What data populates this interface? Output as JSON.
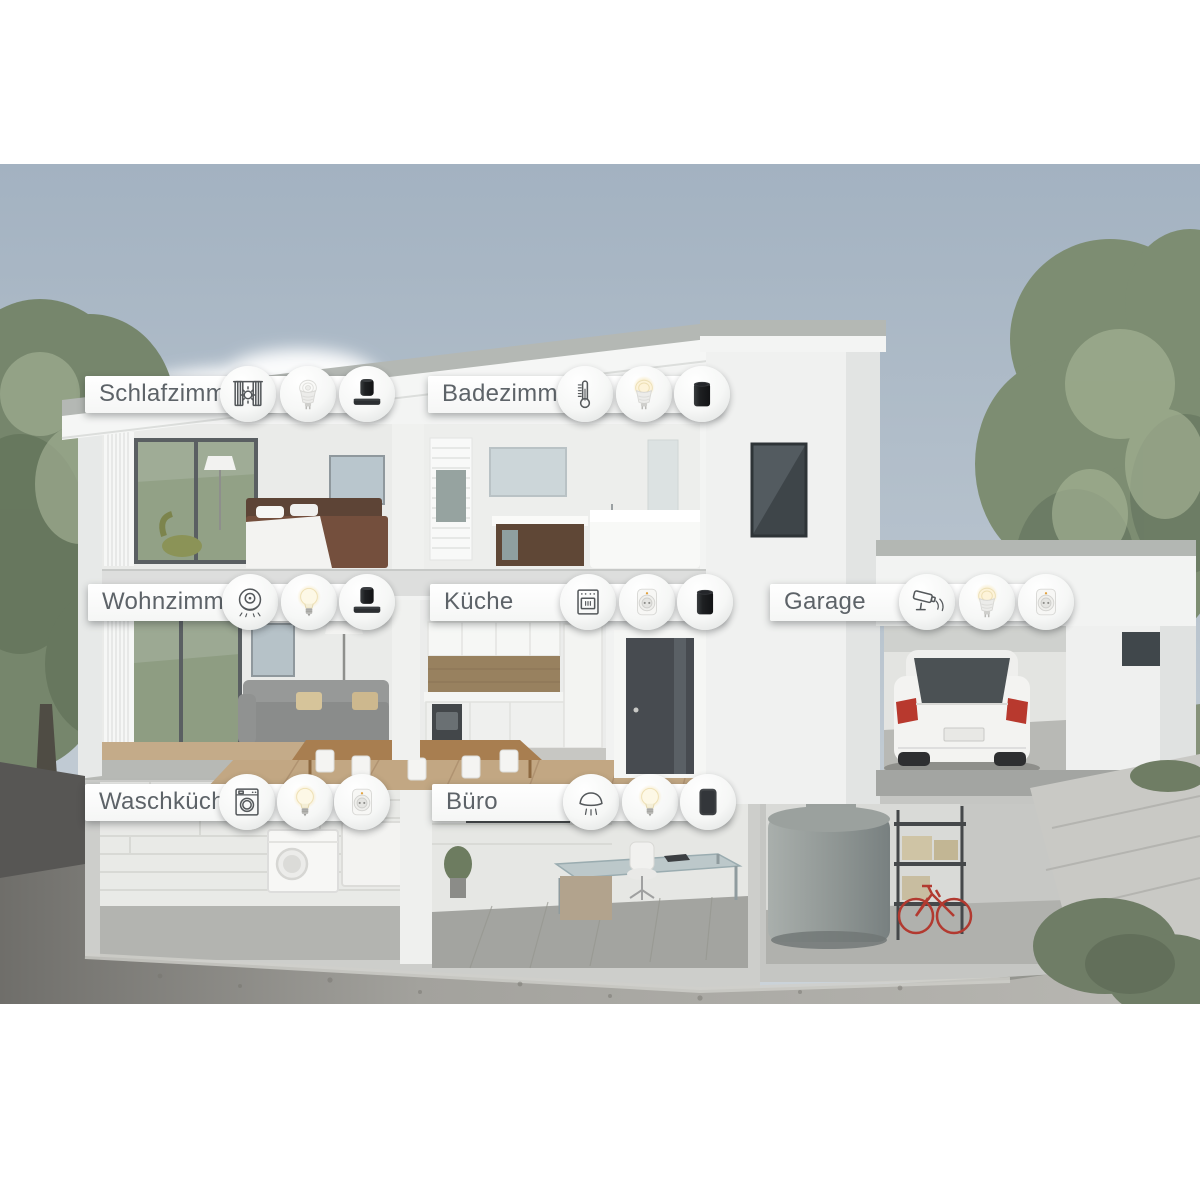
{
  "scene": {
    "description": "Cutaway 3D illustration of a modern flat-roof smart home with basement, garage, garden trees and gravel foreground; each room annotated with smart-home device icons",
    "language": "de",
    "colors": {
      "sky": "#a7b6c3",
      "banner_background": "#ffffff",
      "banner_text": "#5d6368",
      "foliage": "#7d8d72",
      "concrete": "#cdcecb",
      "warm_light_glow": "#f7e7ba",
      "car_taillight_red": "#b8392e"
    }
  },
  "rooms": [
    {
      "name": "Schlafzimmer",
      "devices": [
        {
          "icon": "curtain-blind-icon"
        },
        {
          "icon": "gu10-bulb-device"
        },
        {
          "icon": "speaker-soundbar-device"
        }
      ]
    },
    {
      "name": "Badezimmer",
      "devices": [
        {
          "icon": "thermometer-icon"
        },
        {
          "icon": "gu10-bulb-lit-device"
        },
        {
          "icon": "speaker-cylinder-device"
        }
      ]
    },
    {
      "name": "Wohnzimmer",
      "devices": [
        {
          "icon": "robot-vacuum-icon"
        },
        {
          "icon": "e27-bulb-lit-device"
        },
        {
          "icon": "speaker-soundbar-device"
        }
      ]
    },
    {
      "name": "Küche",
      "devices": [
        {
          "icon": "oven-icon"
        },
        {
          "icon": "smart-plug-device"
        },
        {
          "icon": "speaker-cylinder-device"
        }
      ]
    },
    {
      "name": "Garage",
      "devices": [
        {
          "icon": "security-camera-icon"
        },
        {
          "icon": "gu10-bulb-lit-device"
        },
        {
          "icon": "smart-plug-device"
        }
      ]
    },
    {
      "name": "Waschküche",
      "devices": [
        {
          "icon": "washing-machine-icon"
        },
        {
          "icon": "e27-bulb-lit-device"
        },
        {
          "icon": "smart-plug-device"
        }
      ]
    },
    {
      "name": "Büro",
      "devices": [
        {
          "icon": "smoke-detector-icon"
        },
        {
          "icon": "e27-bulb-lit-device"
        },
        {
          "icon": "speaker-rect-device"
        }
      ]
    }
  ]
}
